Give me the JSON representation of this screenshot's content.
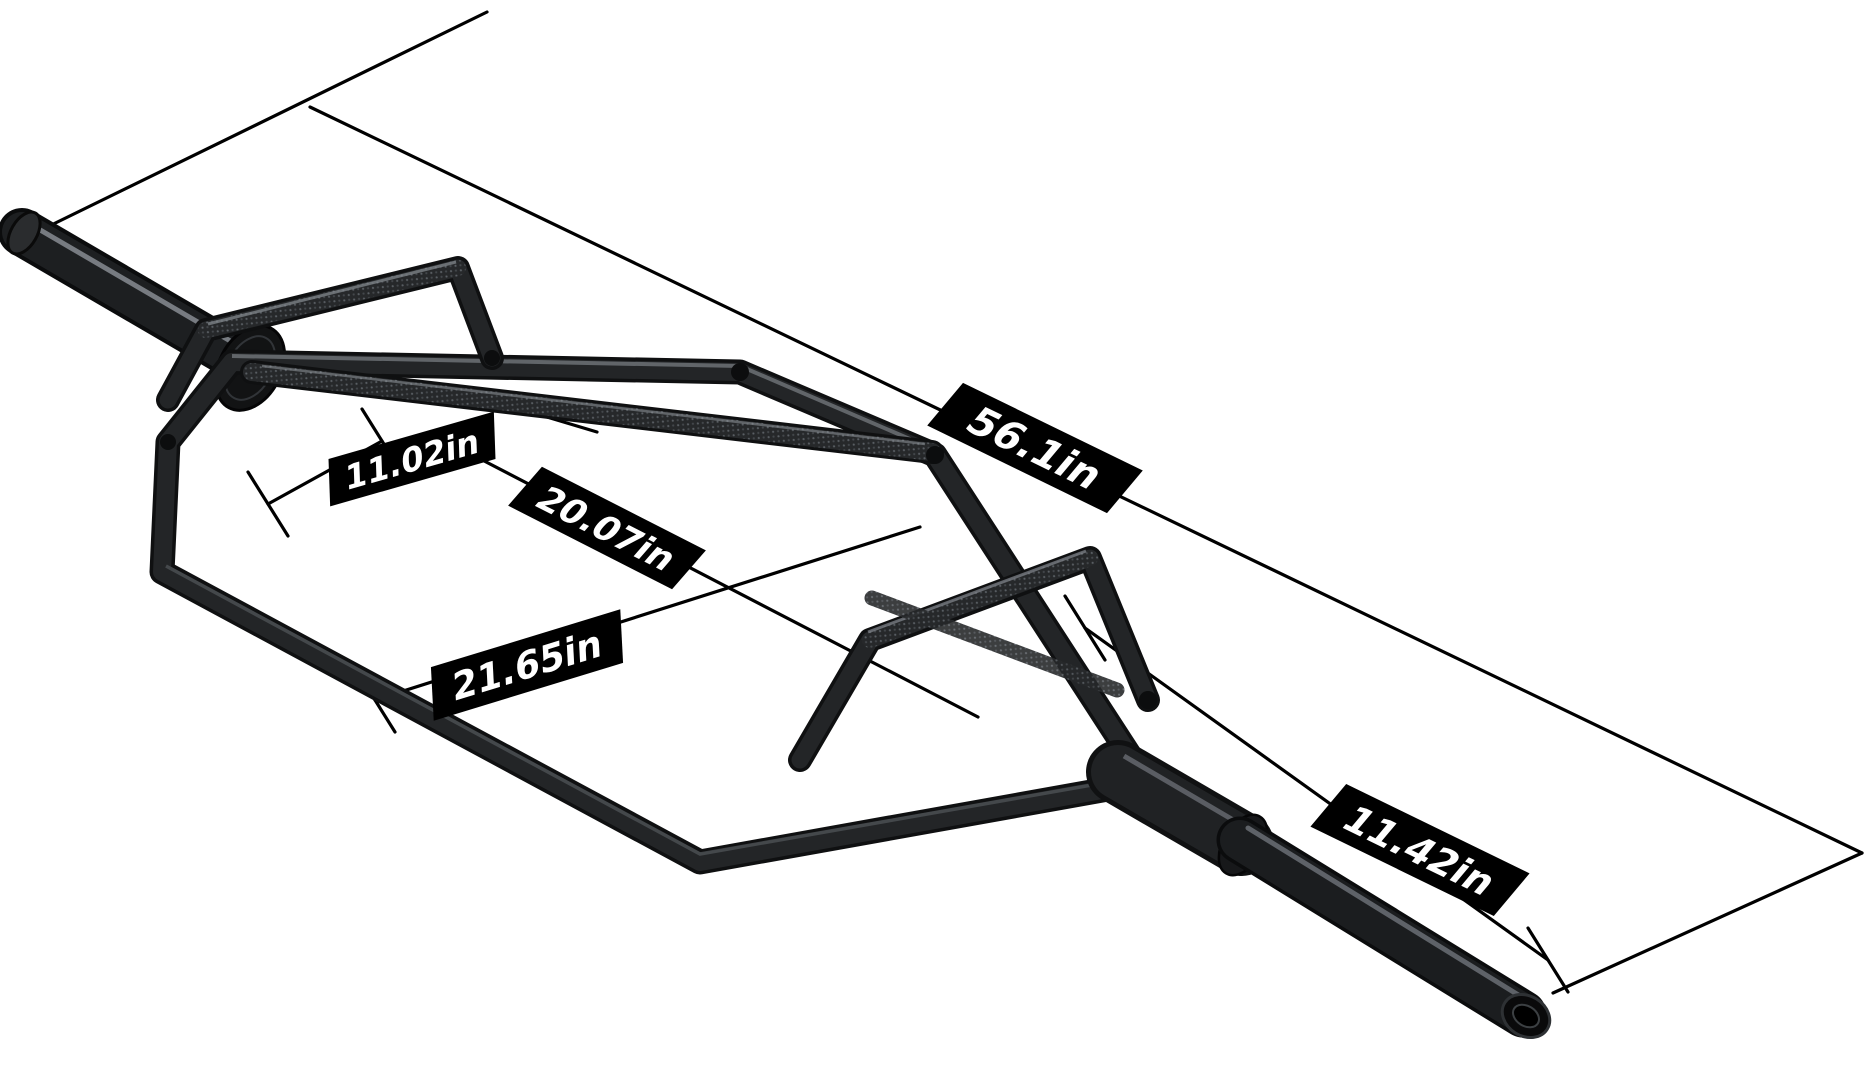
{
  "diagram": {
    "type": "product-dimension-diagram",
    "product": "olympic hex trap deadlift bar",
    "dimension_labels": [
      "56.1in",
      "11.02in",
      "20.07in",
      "21.65in",
      "11.42in"
    ],
    "colors": {
      "background": "#ffffff",
      "dimension_lines": "#000000",
      "label_background": "#000000",
      "label_text": "#ffffff",
      "bar_metal_dark": "#131416",
      "bar_metal_body": "#232527",
      "bar_metal_highlight": "#7c8188",
      "knurl_base": "#26282a",
      "knurl_speckle": "#5a5f64"
    }
  }
}
